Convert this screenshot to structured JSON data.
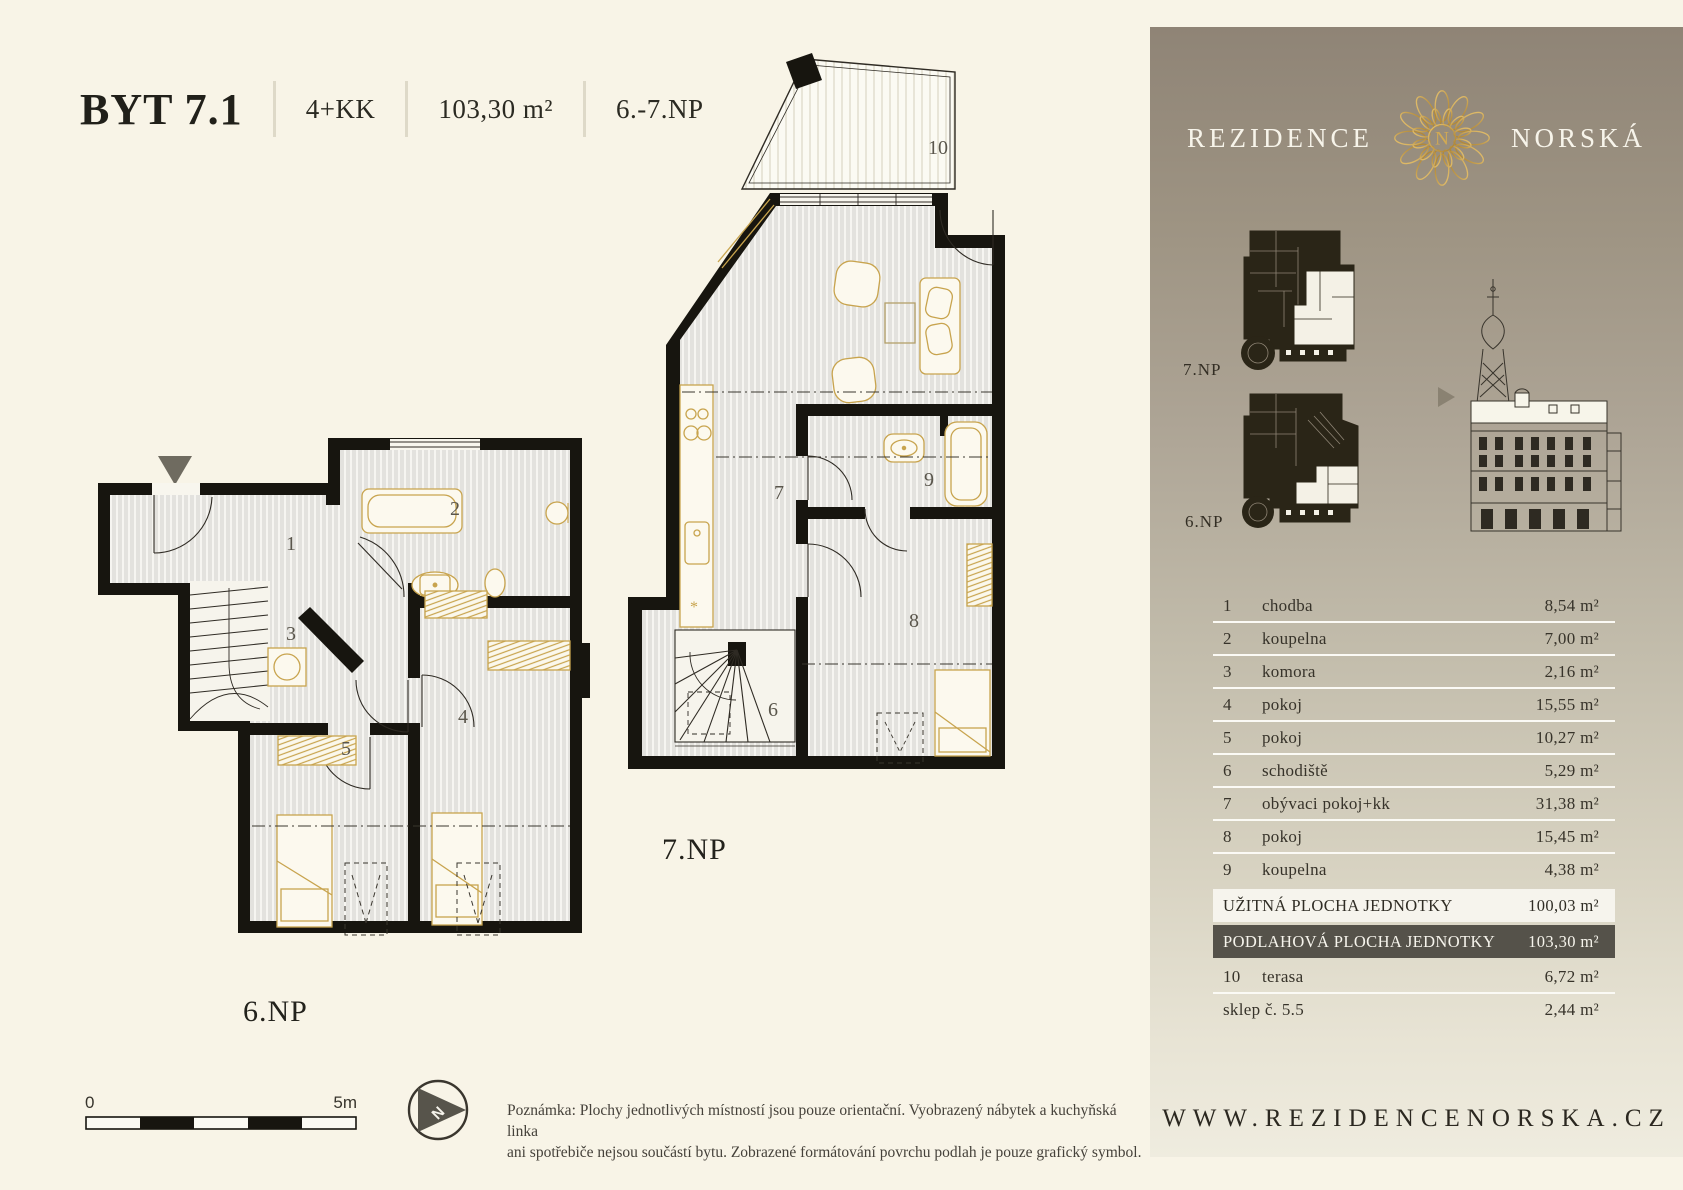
{
  "header": {
    "unit": "BYT 7.1",
    "layout": "4+KK",
    "area": "103,30 m²",
    "floors": "6.-7.NP"
  },
  "plans": {
    "np7": {
      "label": "7.NP",
      "rooms": {
        "r6": "6",
        "r7": "7",
        "r8": "8",
        "r9": "9",
        "r10": "10"
      }
    },
    "np6": {
      "label": "6.NP",
      "rooms": {
        "r1": "1",
        "r2": "2",
        "r3": "3",
        "r4": "4",
        "r5": "5"
      }
    }
  },
  "scalebar": {
    "start": "0",
    "end": "5m"
  },
  "compass": {
    "label": "N"
  },
  "note": {
    "line1": "Poznámka: Plochy jednotlivých místností jsou pouze orientační. Vyobrazený nábytek a kuchyňská linka",
    "line2": "ani spotřebiče nejsou součástí bytu. Zobrazené formátování povrchu podlah je pouze grafický symbol."
  },
  "sidebar": {
    "brand": {
      "left": "REZIDENCE",
      "right": "NORSKÁ",
      "monogram": "N"
    },
    "thumbs": {
      "np7_label": "7.NP",
      "np6_label": "6.NP"
    },
    "table": {
      "rooms": [
        {
          "num": "1",
          "label": "chodba",
          "value": "8,54 m²"
        },
        {
          "num": "2",
          "label": "koupelna",
          "value": "7,00 m²"
        },
        {
          "num": "3",
          "label": "komora",
          "value": "2,16 m²"
        },
        {
          "num": "4",
          "label": "pokoj",
          "value": "15,55 m²"
        },
        {
          "num": "5",
          "label": "pokoj",
          "value": "10,27 m²"
        },
        {
          "num": "6",
          "label": "schodiště",
          "value": "5,29 m²"
        },
        {
          "num": "7",
          "label": "obývaci pokoj+kk",
          "value": "31,38 m²"
        },
        {
          "num": "8",
          "label": "pokoj",
          "value": "15,45 m²"
        },
        {
          "num": "9",
          "label": "koupelna",
          "value": "4,38 m²"
        }
      ],
      "summary": [
        {
          "label": "UŽITNÁ PLOCHA JEDNOTKY",
          "value": "100,03 m²",
          "style": "light"
        },
        {
          "label": "PODLAHOVÁ PLOCHA JEDNOTKY",
          "value": "103,30 m²",
          "style": "dark"
        }
      ],
      "extras": [
        {
          "num": "10",
          "label": "terasa",
          "value": "6,72 m²"
        },
        {
          "num": "",
          "label": "sklep č. 5.5",
          "value": "2,44 m²"
        }
      ]
    },
    "website": "WWW.REZIDENCENORSKA.CZ"
  },
  "colors": {
    "page_bg": "#f8f4e7",
    "wall": "#17150f",
    "floor": "#e3e2de",
    "furniture_gold": "#c8a44e",
    "sidebar_top": "#8f8476",
    "sidebar_bottom": "#efecdf",
    "summary_dark_bg": "#55524a",
    "summary_light_bg": "#f6f4ed",
    "logo_gold": "#d3aa52"
  }
}
